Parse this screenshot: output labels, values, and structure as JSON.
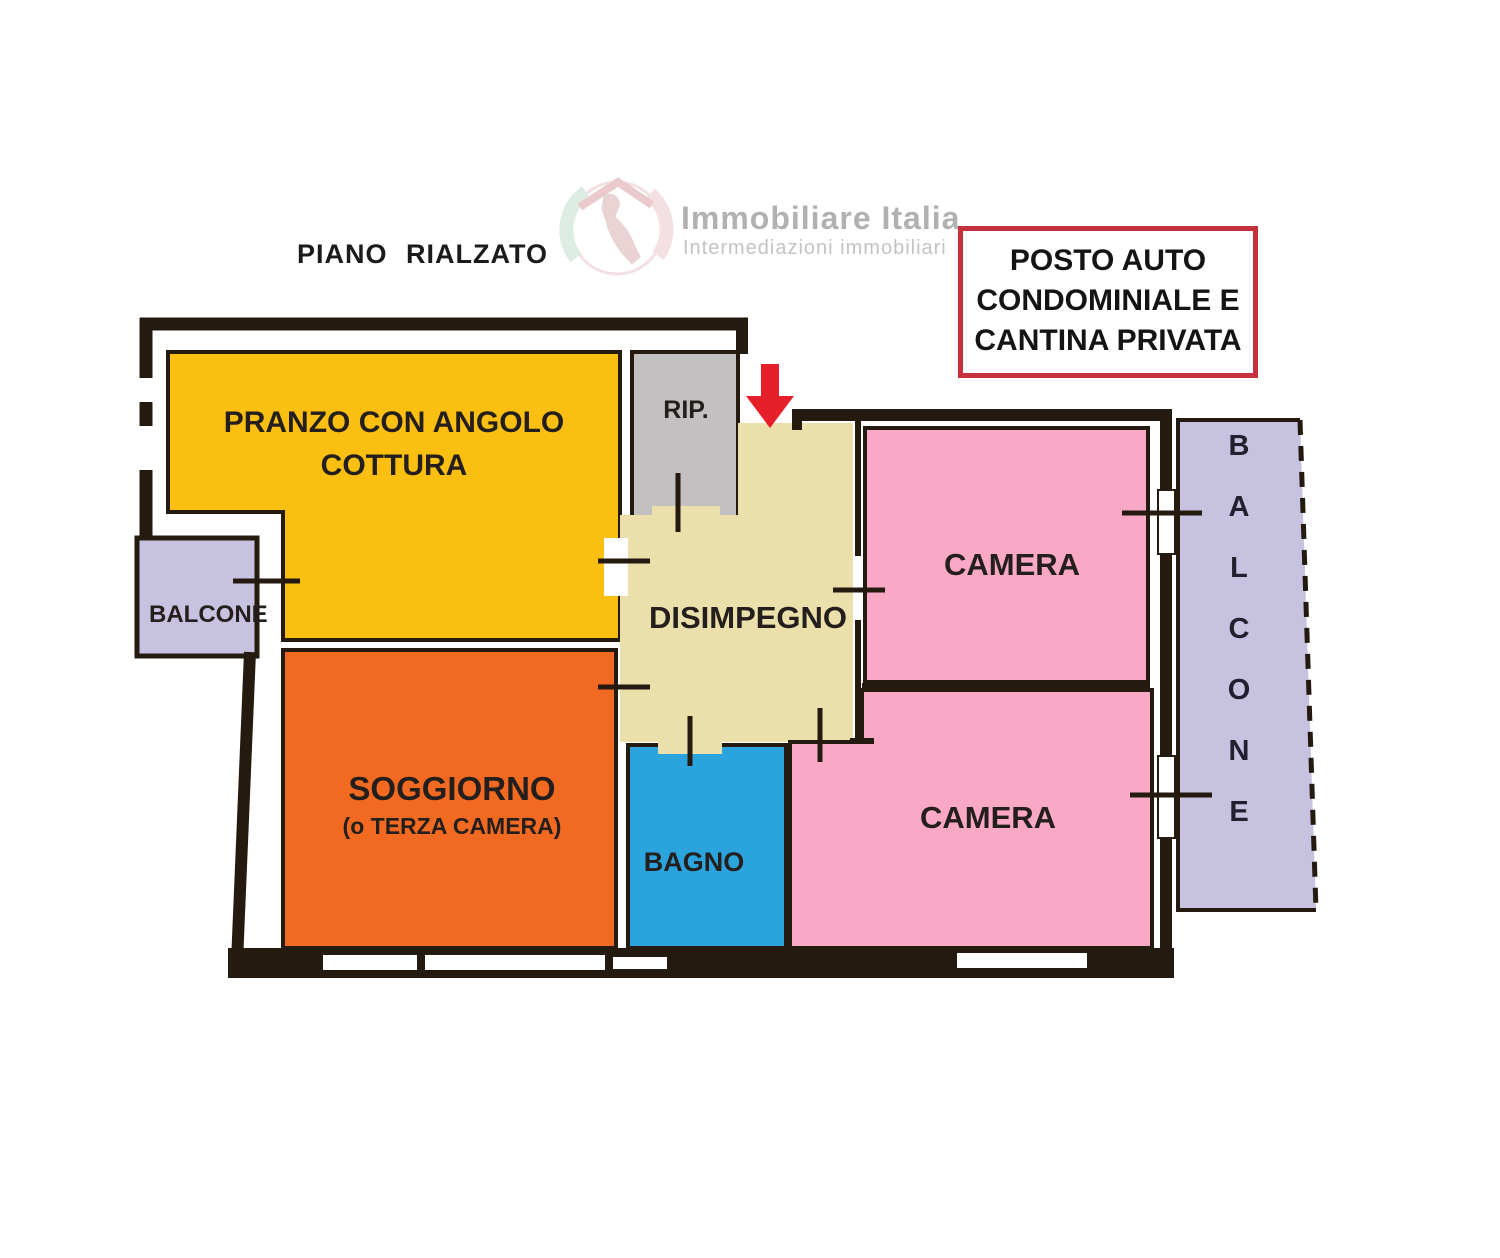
{
  "header": {
    "floor_label": "PIANO RIALZATO",
    "logo": {
      "title": "Immobiliare Italia",
      "subtitle": "Intermediazioni immobiliari"
    },
    "note_box": {
      "lines": [
        "POSTO AUTO",
        "CONDOMINIALE E",
        "CANTINA PRIVATA"
      ],
      "border_color": "#c5323e"
    }
  },
  "plan": {
    "wall_color": "#241a10",
    "entrance_arrow_color": "#e5202a",
    "rooms": {
      "pranzo": {
        "label_lines": [
          "PRANZO CON ANGOLO",
          "COTTURA"
        ],
        "color": "#fbbf11"
      },
      "rip": {
        "label": "RIP.",
        "color": "#c2c0c1"
      },
      "disimpegno": {
        "label": "DISIMPEGNO",
        "color": "#ebdfac"
      },
      "camera_top": {
        "label": "CAMERA",
        "color": "#f9a9c6"
      },
      "camera_bottom": {
        "label": "CAMERA",
        "color": "#f9a9c6"
      },
      "bagno": {
        "label": "BAGNO",
        "color": "#2ba4de"
      },
      "soggiorno": {
        "label": "SOGGIORNO",
        "sublabel": "(o TERZA CAMERA)",
        "color": "#f26a22"
      },
      "balcone_left": {
        "label": "BALCONE",
        "color": "#c6c2e0"
      },
      "balcone_right": {
        "label": "BALCONE",
        "color": "#c6c2e0"
      }
    }
  }
}
